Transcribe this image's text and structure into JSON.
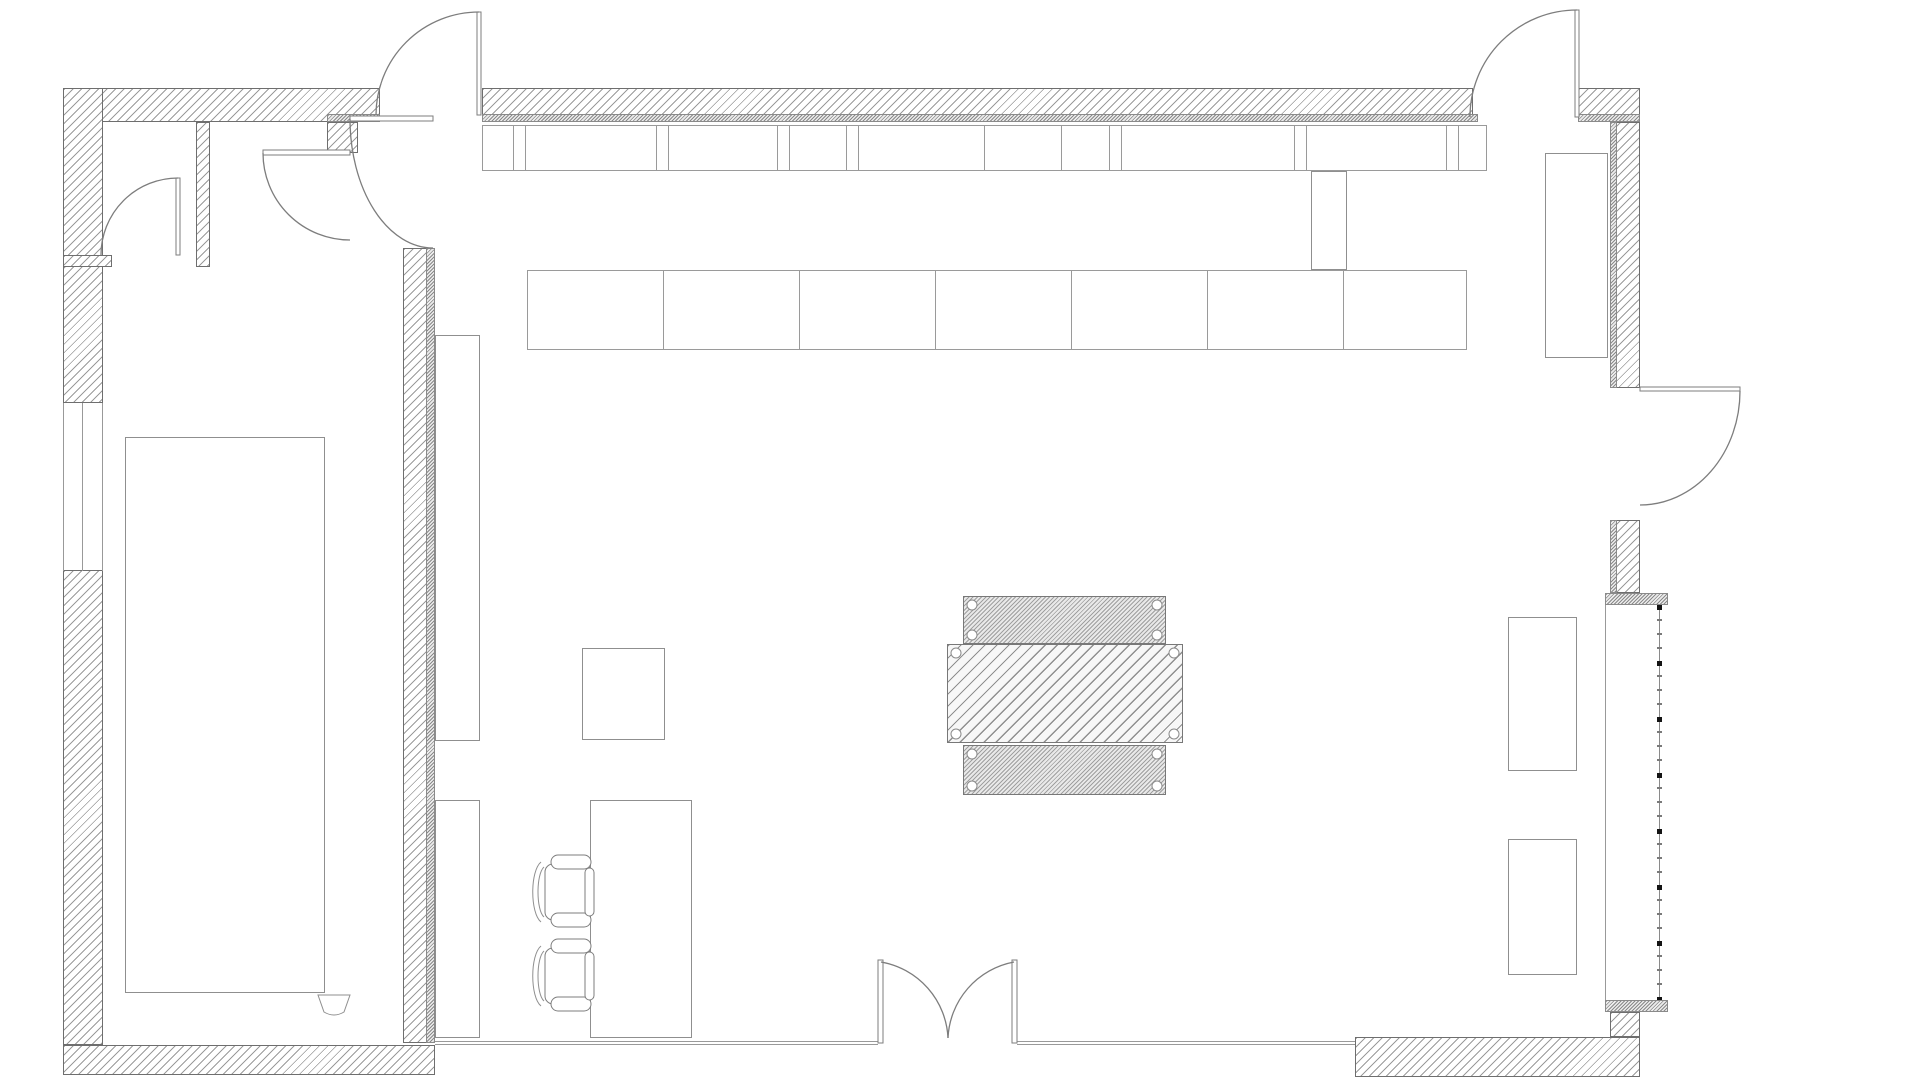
{
  "plan": {
    "canvas": {
      "width": 1920,
      "height": 1080,
      "background": "#ffffff"
    },
    "palette": {
      "wall_outline": "#6e6e6e",
      "hatch_line": "#9b9b9b",
      "dense_hatch_line": "#8a8a8a",
      "furniture_line": "#8f8f8f",
      "glass_line": "#999999",
      "mullion_mark": "#141414"
    },
    "walls": [
      {
        "name": "top-wall-left-section",
        "style": "wall",
        "x": 63,
        "y": 88,
        "w": 317,
        "h": 34
      },
      {
        "name": "top-wall-main-section",
        "style": "wall",
        "x": 482,
        "y": 88,
        "w": 991,
        "h": 34
      },
      {
        "name": "top-wall-right-piece",
        "style": "wall",
        "x": 1578,
        "y": 88,
        "w": 62,
        "h": 34
      },
      {
        "name": "top-wall-inner-face-strip",
        "style": "dense",
        "x": 482,
        "y": 114,
        "w": 996,
        "h": 8
      },
      {
        "name": "top-wall-inner-strip-right",
        "style": "dense",
        "x": 1578,
        "y": 114,
        "w": 62,
        "h": 8
      },
      {
        "name": "top-wall-inner-strip-stub",
        "style": "dense",
        "x": 327,
        "y": 114,
        "w": 53,
        "h": 8
      },
      {
        "name": "left-outer-wall-upper",
        "style": "wall",
        "x": 63,
        "y": 88,
        "w": 40,
        "h": 315
      },
      {
        "name": "left-outer-wall-lower",
        "style": "wall",
        "x": 63,
        "y": 570,
        "w": 40,
        "h": 475
      },
      {
        "name": "closet-partition-wall",
        "style": "wall",
        "x": 196,
        "y": 122,
        "w": 14,
        "h": 145
      },
      {
        "name": "closet-side-stub",
        "style": "wall",
        "x": 63,
        "y": 255,
        "w": 49,
        "h": 12
      },
      {
        "name": "corridor-top-stub",
        "style": "wall",
        "x": 327,
        "y": 122,
        "w": 31,
        "h": 31
      },
      {
        "name": "main-partition-wall",
        "style": "wall",
        "x": 403,
        "y": 248,
        "w": 32,
        "h": 795
      },
      {
        "name": "main-partition-dense-edge",
        "style": "dense",
        "x": 426,
        "y": 248,
        "w": 9,
        "h": 795
      },
      {
        "name": "bottom-wall-left-section",
        "style": "wall",
        "x": 63,
        "y": 1045,
        "w": 372,
        "h": 30
      },
      {
        "name": "right-wall-upper",
        "style": "wall",
        "x": 1610,
        "y": 122,
        "w": 30,
        "h": 266
      },
      {
        "name": "right-wall-upper-dense",
        "style": "dense",
        "x": 1610,
        "y": 122,
        "w": 7,
        "h": 266
      },
      {
        "name": "right-wall-mid-stub",
        "style": "wall",
        "x": 1610,
        "y": 520,
        "w": 30,
        "h": 73
      },
      {
        "name": "right-wall-mid-dense",
        "style": "dense",
        "x": 1610,
        "y": 520,
        "w": 7,
        "h": 73
      },
      {
        "name": "window-cap-top",
        "style": "dense",
        "x": 1605,
        "y": 593,
        "w": 63,
        "h": 12
      },
      {
        "name": "window-cap-bottom",
        "style": "dense",
        "x": 1605,
        "y": 1000,
        "w": 63,
        "h": 12
      },
      {
        "name": "right-wall-bottom-stub",
        "style": "wall",
        "x": 1610,
        "y": 1012,
        "w": 30,
        "h": 25
      },
      {
        "name": "bottom-wall-right-section",
        "style": "wall",
        "x": 1355,
        "y": 1037,
        "w": 285,
        "h": 40
      }
    ],
    "glazing": [
      {
        "name": "bottom-glazing-left",
        "x": 435,
        "y": 1041,
        "w": 443,
        "h": 4
      },
      {
        "name": "bottom-glazing-right",
        "x": 1017,
        "y": 1041,
        "w": 338,
        "h": 4
      }
    ],
    "window_left_lines": [
      {
        "name": "left-window-glass-line-outer",
        "x": 63,
        "y": 403,
        "w": 1,
        "h": 168
      },
      {
        "name": "left-window-glass-line-middle",
        "x": 82,
        "y": 403,
        "w": 1,
        "h": 168
      },
      {
        "name": "left-window-glass-line-inner",
        "x": 102,
        "y": 403,
        "w": 1,
        "h": 168
      }
    ],
    "right_window": {
      "name": "right-curtain-wall",
      "mullion": {
        "x": 1657,
        "y": 605,
        "w": 5,
        "h": 395
      },
      "inner_line": {
        "x": 1605,
        "y": 605,
        "w": 1,
        "h": 395
      },
      "square_mark_spacing": 56,
      "dot_mark_spacing": 14
    },
    "top_strip": {
      "name": "window-sill-counter-strip",
      "x": 482,
      "y": 125,
      "w": 1005,
      "h": 46,
      "dividers": [
        30,
        42,
        173,
        185,
        294,
        306,
        363,
        375,
        501,
        578,
        626,
        638,
        811,
        823,
        963,
        975
      ]
    },
    "counter_row": {
      "name": "upper-counter-row",
      "x": 527,
      "y": 270,
      "w": 940,
      "h": 80,
      "dividers": [
        135,
        271,
        407,
        543,
        679,
        815
      ]
    },
    "furniture": [
      {
        "name": "partition-counter-upper",
        "x": 435,
        "y": 335,
        "w": 45,
        "h": 406
      },
      {
        "name": "partition-counter-lower",
        "x": 435,
        "y": 800,
        "w": 45,
        "h": 238
      },
      {
        "name": "side-table",
        "x": 582,
        "y": 648,
        "w": 83,
        "h": 92
      },
      {
        "name": "reception-desk",
        "x": 590,
        "y": 800,
        "w": 102,
        "h": 238
      },
      {
        "name": "left-room-floor-mat",
        "x": 125,
        "y": 437,
        "w": 200,
        "h": 556
      },
      {
        "name": "tall-cabinet-right",
        "x": 1545,
        "y": 153,
        "w": 63,
        "h": 205
      },
      {
        "name": "right-seat-upper",
        "x": 1508,
        "y": 617,
        "w": 69,
        "h": 154
      },
      {
        "name": "right-seat-lower",
        "x": 1508,
        "y": 839,
        "w": 69,
        "h": 136
      },
      {
        "name": "column-duct",
        "x": 1311,
        "y": 171,
        "w": 36,
        "h": 99
      }
    ],
    "center_table": {
      "name": "central-work-table",
      "parts": [
        {
          "name": "table-top-leaf",
          "hatch": "fine",
          "x": 963,
          "y": 596,
          "w": 203,
          "h": 48
        },
        {
          "name": "table-main-leaf",
          "hatch": "coarse",
          "x": 947,
          "y": 644,
          "w": 236,
          "h": 99
        },
        {
          "name": "table-bottom-leaf",
          "hatch": "fine",
          "x": 963,
          "y": 745,
          "w": 203,
          "h": 50
        }
      ],
      "screw": {
        "radius": 5,
        "inset": 9
      }
    },
    "doors": [
      {
        "name": "exterior-door-top-left",
        "leaf": {
          "x": 477,
          "y": 12,
          "w": 4,
          "h": 103
        },
        "arc": "M479,12 A103,103 0 0 0 376,115"
      },
      {
        "name": "exterior-door-top-right",
        "leaf": {
          "x": 1575,
          "y": 10,
          "w": 4,
          "h": 107
        },
        "arc": "M1577,10 A107,107 0 0 0 1470,117"
      },
      {
        "name": "exterior-door-right",
        "leaf": {
          "x": 1640,
          "y": 387,
          "w": 100,
          "h": 4
        },
        "arc": "M1740,391 A100,114 0 0 1 1640,505"
      },
      {
        "name": "closet-door",
        "leaf": {
          "x": 176,
          "y": 178,
          "w": 4,
          "h": 77
        },
        "arc": "M178,178 A77,77 0 0 0 101,255"
      },
      {
        "name": "left-room-door",
        "leaf": {
          "x": 263,
          "y": 150,
          "w": 87,
          "h": 5
        },
        "arc": "M263,153 A87,87 0 0 0 350,240"
      },
      {
        "name": "corridor-door",
        "leaf": {
          "x": 350,
          "y": 116,
          "w": 83,
          "h": 5
        },
        "arc": "M350,119 A83,129 0 0 0 433,248"
      },
      {
        "name": "double-door-left-leaf",
        "leaf": {
          "x": 878,
          "y": 960,
          "w": 5,
          "h": 83
        },
        "arc": "M881,962 A81,81 0 0 1 948,1038"
      },
      {
        "name": "double-door-right-leaf",
        "leaf": {
          "x": 1012,
          "y": 960,
          "w": 5,
          "h": 83
        },
        "arc": "M1014,962 A81,81 0 0 0 948,1038"
      }
    ],
    "chairs": [
      {
        "name": "desk-chair-1",
        "x": 528,
        "y": 855
      },
      {
        "name": "desk-chair-2",
        "x": 528,
        "y": 939
      }
    ],
    "fixture": {
      "name": "wall-basin",
      "path": "M318,995 L350,995 L344,1012 Q334,1018 324,1012 Z"
    }
  }
}
